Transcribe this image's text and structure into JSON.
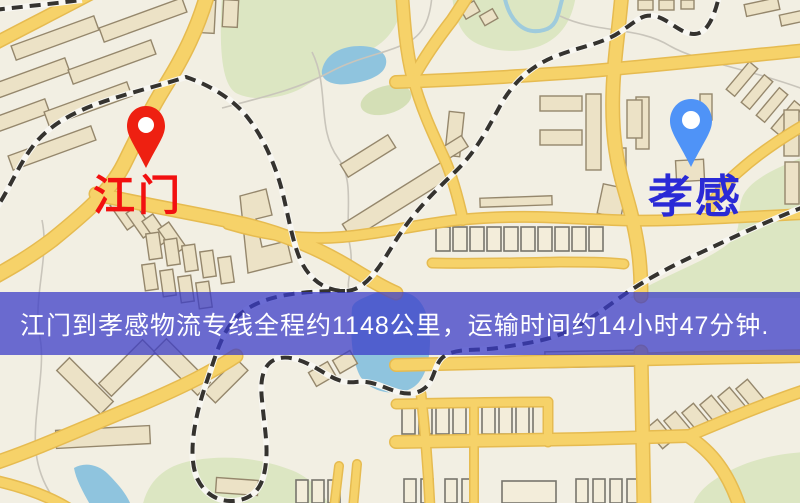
{
  "banner": {
    "text": "江门到孝感物流专线全程约1148公里，运输时间约14小时47分钟.",
    "distance_km": 1148,
    "duration_text": "14小时47分钟",
    "background_color": "#3a3cc8",
    "text_color": "#ffffff"
  },
  "markers": {
    "origin": {
      "label": "江门",
      "label_color": "#f21010",
      "pin_color": "#ee2011",
      "pin_icon": "map-pin"
    },
    "destination": {
      "label": "孝感",
      "label_color": "#2a2ad6",
      "pin_color": "#4f93f7",
      "pin_icon": "map-pin"
    }
  },
  "map": {
    "palette": {
      "background": "#f2efe3",
      "park_green": "#dce6c2",
      "water_blue": "#8fc4de",
      "road_yellow": "#f6d269",
      "road_casing": "#e6bb50",
      "railway_dark": "#35332f",
      "railway_light": "#f8f7f2",
      "building_fill": "#ece2c6",
      "building_stroke": "#95876c"
    }
  }
}
